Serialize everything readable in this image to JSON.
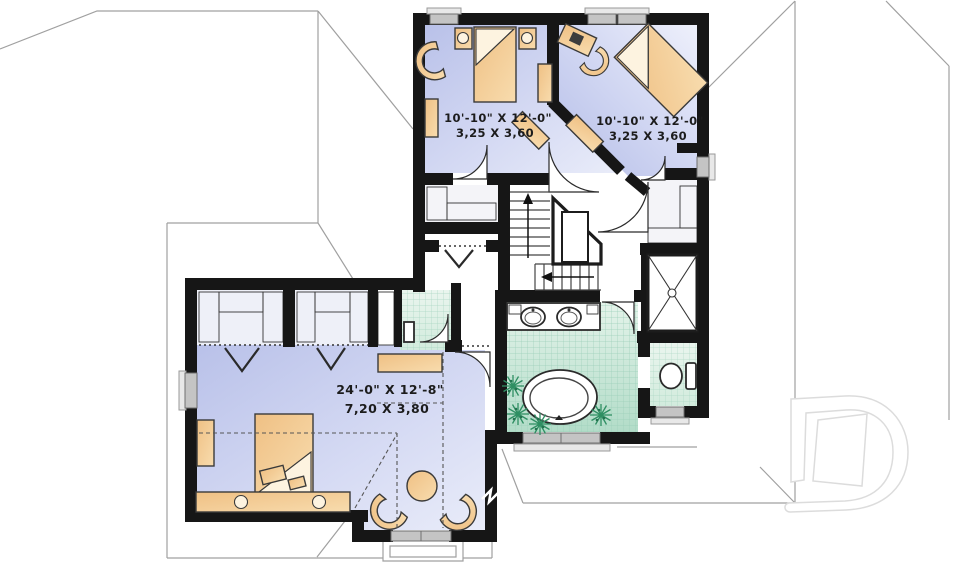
{
  "plan": {
    "kind": "second-floor-plan",
    "rooms": {
      "bedroom_left": {
        "dimensions_imperial": "10'-10\" X 12'-0\"",
        "dimensions_metric": "3,25 X 3,60"
      },
      "bedroom_right": {
        "dimensions_imperial": "10'-10\" X 12'-0\"",
        "dimensions_metric": "3,25 X 3,60"
      },
      "master_bedroom": {
        "dimensions_imperial": "24'-0\" X 12'-8\"",
        "dimensions_metric": "7,20 X 3,80"
      }
    },
    "watermark": {
      "letter": "D"
    },
    "colors": {
      "wall": "#161616",
      "bedroom_floor": "#c9cfef",
      "bath_floor": "#bfe3d2",
      "furniture": "#f0c27c",
      "roof_line": "#a0a0a0",
      "plant": "#2f8f63",
      "watermark": "#dcdcdc"
    }
  }
}
